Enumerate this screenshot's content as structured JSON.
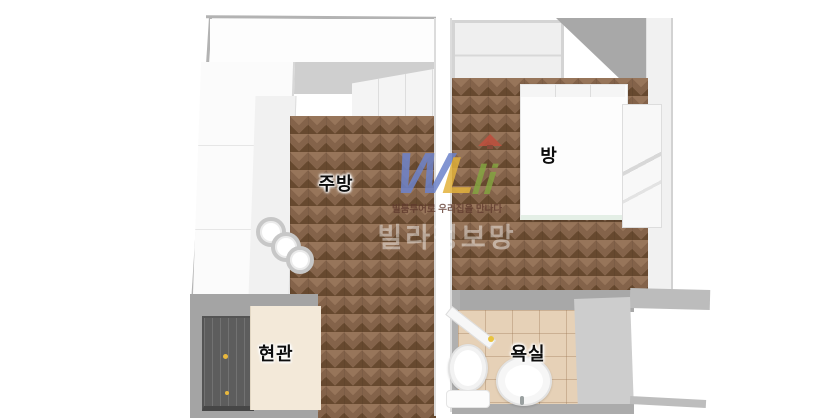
{
  "scene": {
    "type": "3d-floorplan-top-view",
    "background": "#ffffff"
  },
  "rooms": [
    {
      "id": "kitchen",
      "label": "주방"
    },
    {
      "id": "bedroom",
      "label": "방"
    },
    {
      "id": "entrance",
      "label": "현관"
    },
    {
      "id": "bathroom",
      "label": "욕실"
    }
  ],
  "watermark": {
    "letters": [
      {
        "glyph": "W",
        "color": "#6d83cb"
      },
      {
        "glyph": "L",
        "color": "#e3b23c"
      },
      {
        "glyph": "li",
        "color": "#84a441"
      }
    ],
    "roof_color": "#c0503e",
    "tagline": "빌룸투어로 우리집을 만나다",
    "brand": "빌라정보망"
  },
  "palette": {
    "wood_floor": "#84634a",
    "bathroom_tile": "#e6d1b7",
    "entrance_tile": "#f3e9d9",
    "wall_gray": "#a8a8a8",
    "wall_light_gray": "#cfcfcf",
    "wall_white": "#f5f5f5",
    "front_door_gray": "#5d5d5d",
    "doorknob_yellow": "#e9b83d"
  }
}
